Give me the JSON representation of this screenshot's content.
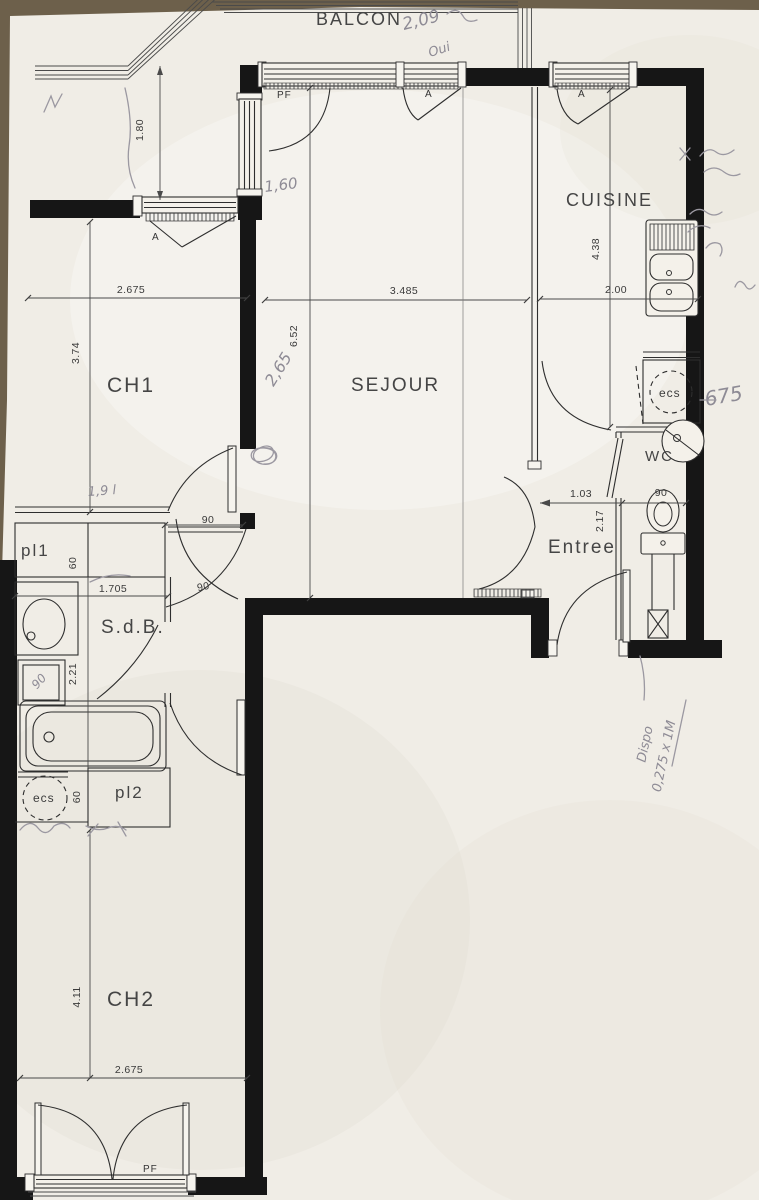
{
  "scan": {
    "table_color": "#6d604b",
    "paper_color": "#f0ede6",
    "ink_color": "#2e2e2e",
    "pencil_color": "#8e8b95"
  },
  "plan": {
    "balcony": "BALCON",
    "rooms": {
      "ch1": "CH1",
      "sejour": "SEJOUR",
      "cuisine": "CUISINE",
      "sdb": "S.d.B.",
      "entree": "Entree",
      "wc": "WC",
      "ch2": "CH2",
      "pl1": "pl1",
      "pl2": "pl2"
    },
    "fixtures": {
      "ecs_kitchen": "ecs",
      "ecs_sdb": "ecs"
    },
    "windows": {
      "pf_sejour": "PF",
      "a_ch1": "A",
      "a_sejour": "A",
      "a_cuisine": "A",
      "pf_ch2": "PF"
    },
    "dimensions": {
      "balcony_depth": "1.80",
      "ch1_width": "2.675",
      "sejour_width": "3.485",
      "cuisine_width": "2.00",
      "cuisine_depth": "4.38",
      "sejour_depth": "6.52",
      "ch1_depth": "3.74",
      "entree_width": "1.03",
      "wc_width": "90",
      "entree_depth": "2.17",
      "pl1_depth": "60",
      "sdb_width": "1.705",
      "sdb_depth": "2.21",
      "ecs_width": "60",
      "sdb_door": "90",
      "hall_door": "90",
      "ch2_depth": "4.11",
      "ch2_width": "2.675"
    },
    "handwritten": {
      "top_note": "2,09",
      "top_note2": "Oui",
      "balcony_window_note": "1,60",
      "sejour_wall_note": "2,65",
      "hall_note": "1,9 l",
      "kitchen_note": "675",
      "shower_note": "90",
      "dispo_line1": "Dispo",
      "dispo_line2": "0,275 x 1M"
    }
  }
}
